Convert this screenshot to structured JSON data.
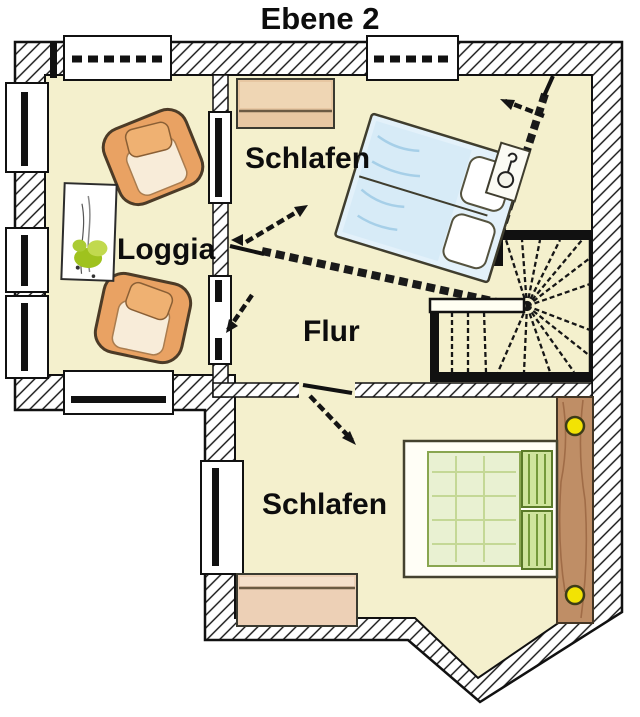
{
  "title": "Ebene 2",
  "rooms": [
    {
      "id": "schlafen-top",
      "label": "Schlafen"
    },
    {
      "id": "loggia",
      "label": "Loggia"
    },
    {
      "id": "flur",
      "label": "Flur"
    },
    {
      "id": "schlafen-bottom",
      "label": "Schlafen"
    }
  ],
  "icons": {
    "stairs": "winder-staircase",
    "bed_top": "double-bed-rotated",
    "bed_bottom": "double-bed",
    "armchairs": "armchair",
    "plant": "potted-plant-picture",
    "door_arrows": "door-swing-arrow",
    "windows": "window",
    "sideboards": "sideboard"
  },
  "colors": {
    "floor": "#f4f0cd",
    "wall_hatch": "#111111",
    "bed_blue": "#e3f1fa",
    "bed_green": "#e9f1d2",
    "pillow_green": "#cfe49c",
    "wood_tan": "#e7c7a2",
    "headboard_brown": "#bf8e66",
    "knob_yellow": "#f2e304",
    "chair_orange": "#e9a263",
    "plant_green": "#9fc21e",
    "label_text": "#0d0d0d"
  }
}
